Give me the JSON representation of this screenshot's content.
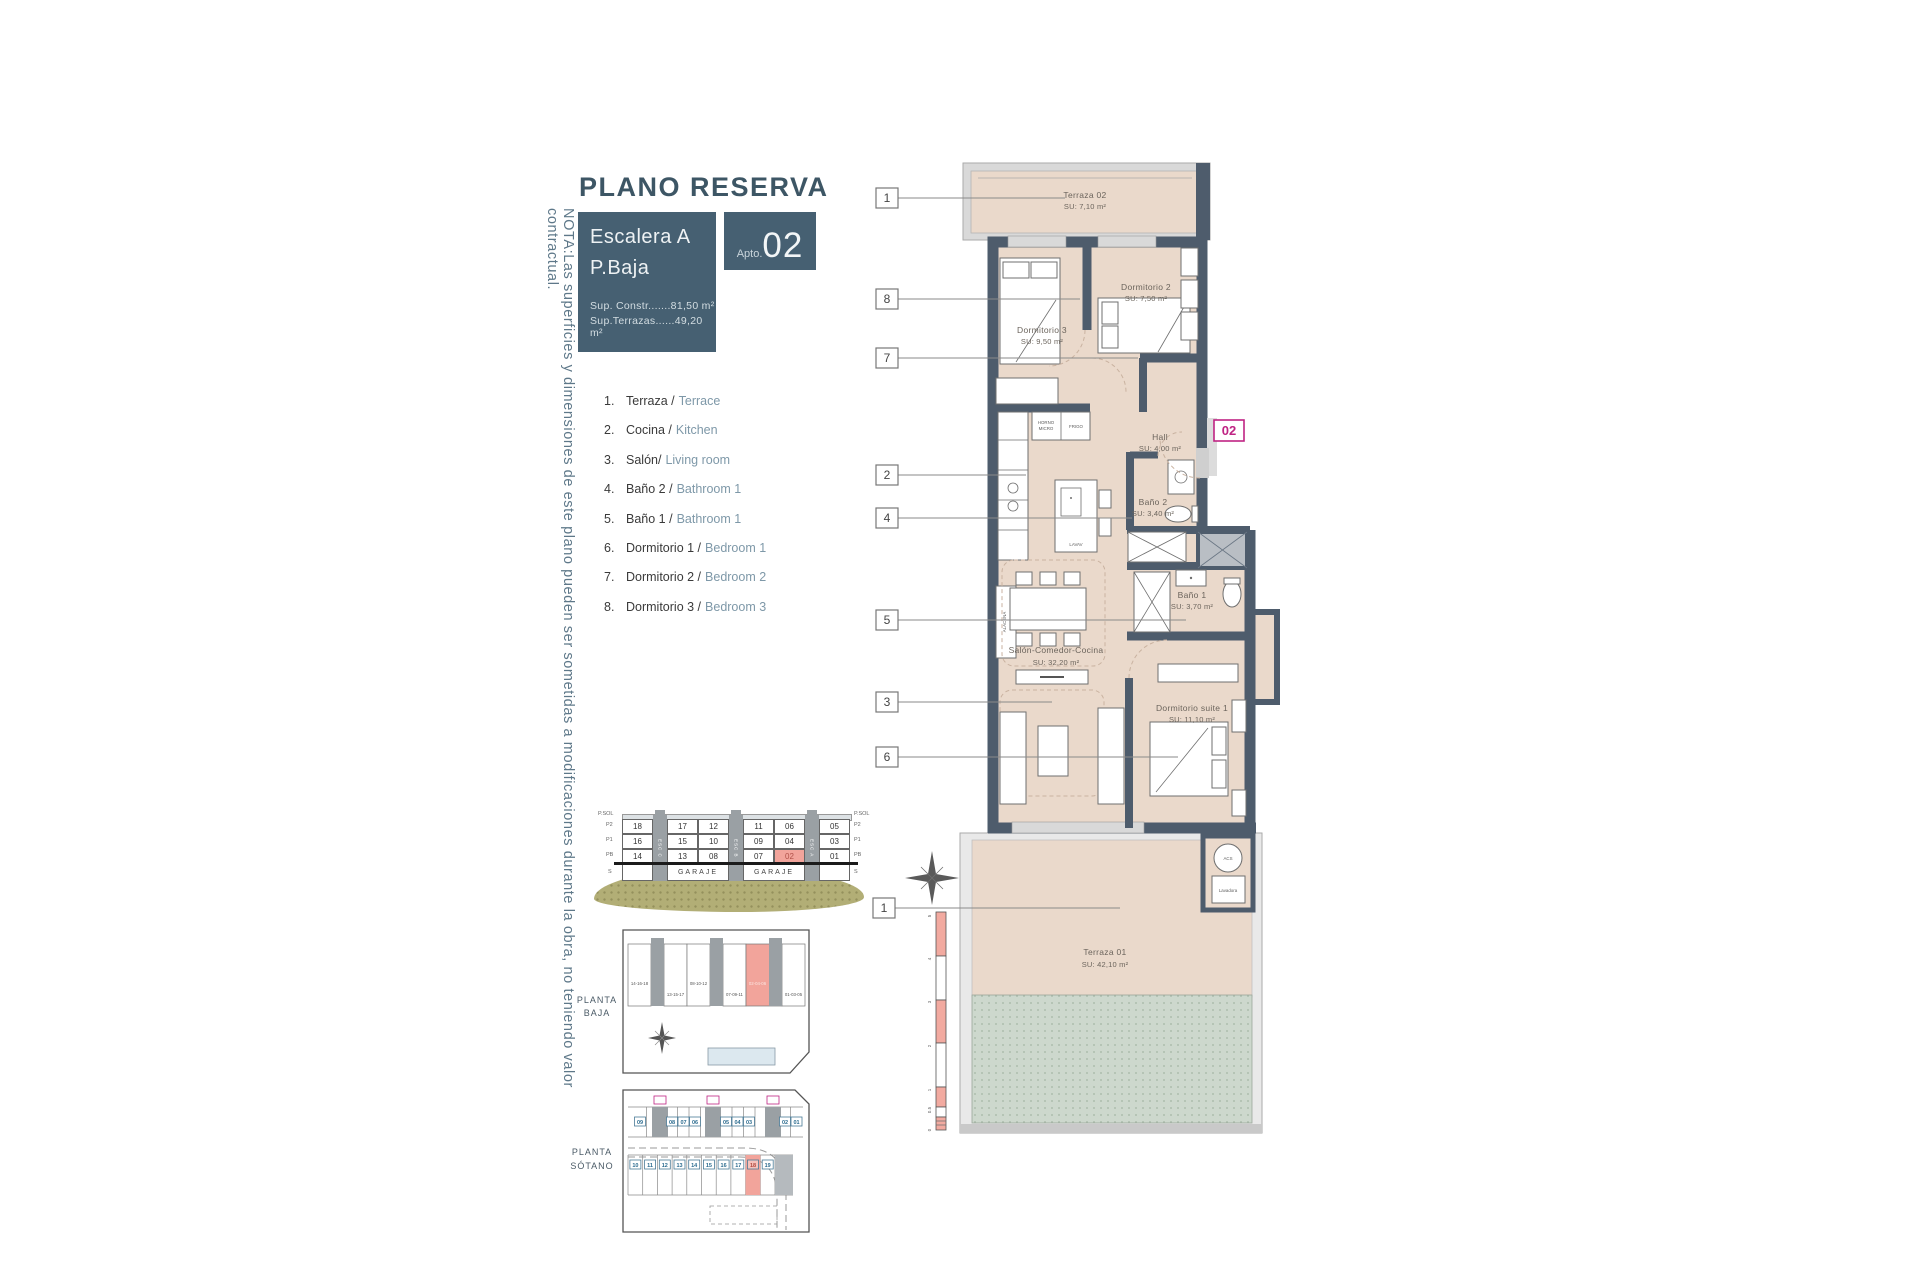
{
  "colors": {
    "accent_magenta": "#bf2383",
    "highlight_red": "#f2a49b",
    "wall": "#4e5c6c",
    "floor_beige": "#ead9cb",
    "brand_teal": "#466072",
    "ground_olive": "#b2ae76"
  },
  "note": "NOTA:Las superficies y dimensiones de este plano pueden ser sometidas a modificaciones durante la obra, no teniendo valor contractual.",
  "header": {
    "title": "PLANO RESERVA",
    "escalera": "Escalera A",
    "planta": "P.Baja",
    "apto_label": "Apto.",
    "apto_num": "02",
    "sup1": "Sup. Constr.......81,50 m²",
    "sup2": "Sup.Terrazas......49,20 m²"
  },
  "legend": [
    {
      "n": "1.",
      "es": "Terraza /",
      "en": "Terrace"
    },
    {
      "n": "2.",
      "es": "Cocina /",
      "en": "Kitchen"
    },
    {
      "n": "3.",
      "es": "Salón/",
      "en": "Living room"
    },
    {
      "n": "4.",
      "es": "Baño 2 /",
      "en": "Bathroom 1"
    },
    {
      "n": "5.",
      "es": "Baño 1 /",
      "en": "Bathroom 1"
    },
    {
      "n": "6.",
      "es": "Dormitorio 1 /",
      "en": "Bedroom 1"
    },
    {
      "n": "7.",
      "es": "Dormitorio 2 /",
      "en": "Bedroom 2"
    },
    {
      "n": "8.",
      "es": "Dormitorio 3 /",
      "en": "Bedroom 3"
    }
  ],
  "plan": {
    "badge": "02",
    "callouts": [
      "1",
      "8",
      "7",
      "2",
      "4",
      "5",
      "3",
      "6",
      "1"
    ],
    "rooms": {
      "terraza02": {
        "name": "Terraza 02",
        "area": "SU: 7,10 m²"
      },
      "dorm3": {
        "name": "Dormitorio 3",
        "area": "SU: 9,50 m²"
      },
      "dorm2": {
        "name": "Dormitorio 2",
        "area": "SU: 7,50 m²"
      },
      "hall": {
        "name": "Hall",
        "area": "SU: 4,00 m²"
      },
      "bano2": {
        "name": "Baño 2",
        "area": "SU: 3,40 m²"
      },
      "bano1": {
        "name": "Baño 1",
        "area": "SU: 3,70 m²"
      },
      "salon": {
        "name": "Salón-Comedor-Cocina",
        "area": "SU: 32,20 m²"
      },
      "suite": {
        "name": "Dormitorio suite 1",
        "area": "SU: 11,10 m²"
      },
      "terraza01": {
        "name": "Terraza 01",
        "area": "SU: 42,10 m²"
      }
    },
    "labels": {
      "horno1": "HORNO",
      "horno2": "MICRO",
      "frigo": "FRIGO",
      "lavav": "LAVAV",
      "alacena": "ALACENA",
      "acs": "ACS",
      "lavadora": "Lavadora"
    },
    "scale": [
      "5",
      "4",
      "3",
      "2",
      "1",
      "0.5",
      "0"
    ]
  },
  "section": {
    "floors": [
      "P.SOL",
      "P2",
      "P1",
      "PB",
      "S"
    ],
    "esc": [
      "ESC C",
      "ESC B",
      "ESC A"
    ],
    "row_p2": [
      "18",
      "17",
      "12",
      "11",
      "06",
      "05"
    ],
    "row_p1": [
      "16",
      "15",
      "10",
      "09",
      "04",
      "03"
    ],
    "row_pb": [
      "14",
      "13",
      "08",
      "07",
      "02",
      "01"
    ],
    "garaje": "GARAJE"
  },
  "planta_baja": {
    "line1": "PLANTA",
    "line2": "BAJA",
    "groups": [
      "14-16-18",
      "13-15-17",
      "08-10-12",
      "07-09-11",
      "02-04-06",
      "01-03-05"
    ]
  },
  "planta_sotano": {
    "line1": "PLANTA",
    "line2": "SÓTANO",
    "top": [
      "09",
      "08",
      "07",
      "06",
      "05",
      "04",
      "03",
      "02",
      "01"
    ],
    "bottom": [
      "10",
      "11",
      "12",
      "13",
      "14",
      "15",
      "16",
      "17",
      "18",
      "19"
    ]
  }
}
